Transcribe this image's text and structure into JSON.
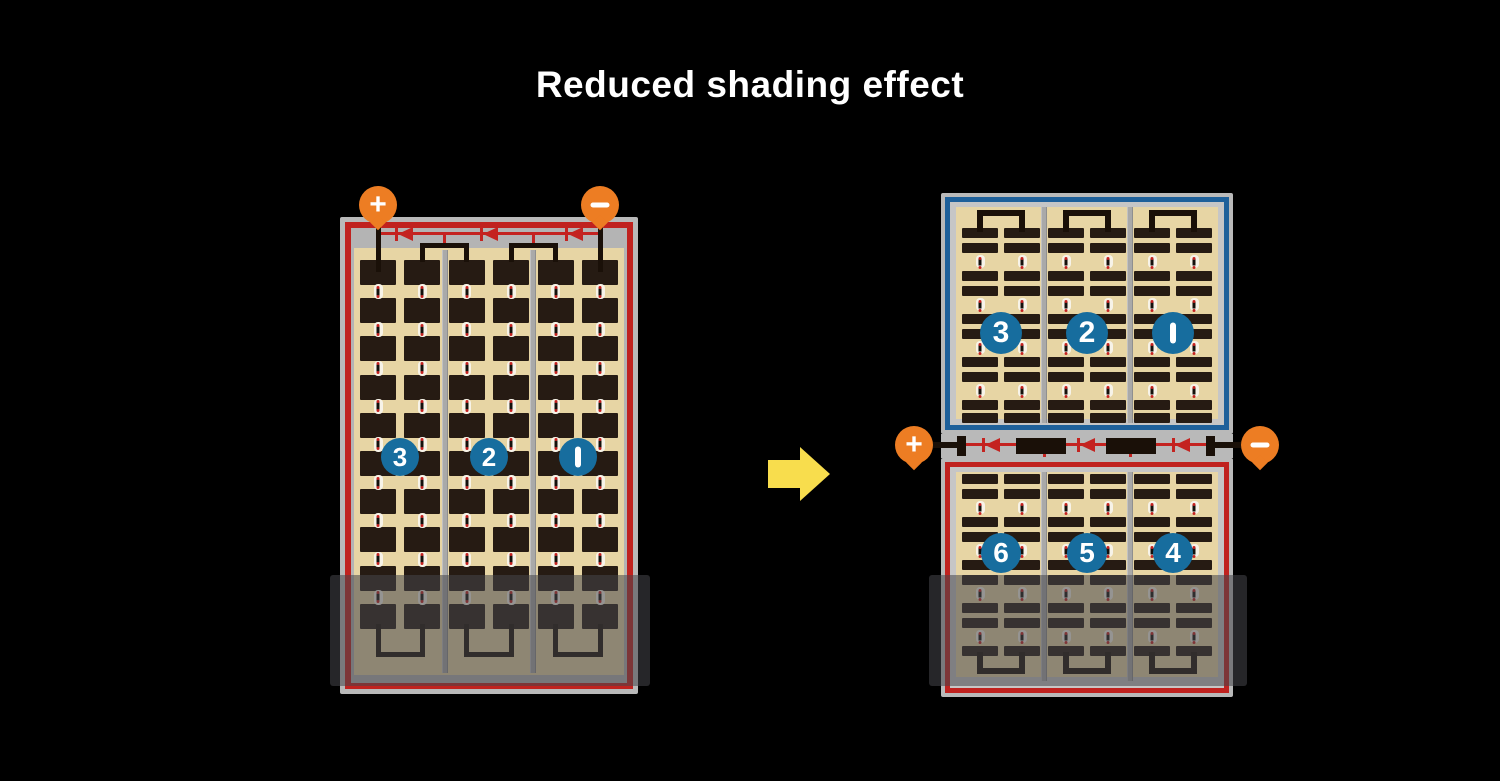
{
  "title": "Reduced shading effect",
  "colors": {
    "background": "#000000",
    "panel_frame_gray": "#b9b9b9",
    "series_red": "#c0221f",
    "parallel_blue": "#1e609a",
    "cell_tan": "#e7d5a4",
    "cell_dark": "#261b13",
    "terminal_orange": "#ed7d23",
    "number_circle_blue": "#176d9e",
    "diode_red": "#c42320",
    "arrow_yellow": "#f8dd4d",
    "wire_black": "#1a1008",
    "shade_overlay": "rgba(70,70,74,0.55)"
  },
  "left_module": {
    "terminals": {
      "positive": "+",
      "negative": "−"
    },
    "cell_columns": 6,
    "cell_rows": 10,
    "bypass_diode_count": 3,
    "string_labels": [
      "3",
      "2",
      "1"
    ]
  },
  "right_module": {
    "terminals": {
      "positive": "+",
      "negative": "−"
    },
    "bypass_diode_count": 3,
    "top_half": {
      "columns": 3,
      "strip_rows": 10,
      "string_labels": [
        "3",
        "2",
        "1"
      ]
    },
    "bottom_half": {
      "columns": 3,
      "strip_rows": 9,
      "string_labels": [
        "6",
        "5",
        "4"
      ]
    }
  }
}
